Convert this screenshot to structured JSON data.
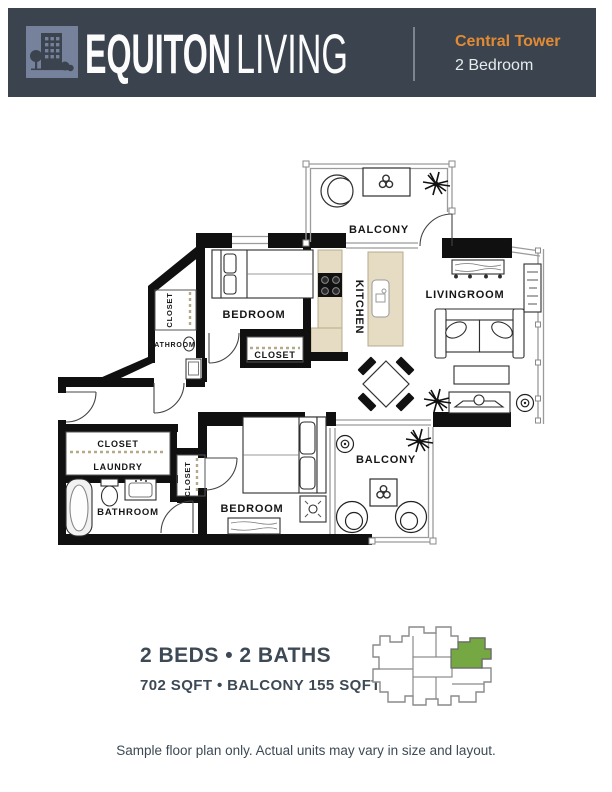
{
  "header": {
    "brand_bold": "EQUITON",
    "brand_light": "LIVING",
    "tower": "Central Tower",
    "unit_type": "2 Bedroom",
    "bg_color": "#3A434E",
    "accent_color": "#E28B33",
    "logo_color": "#76829B"
  },
  "floorplan": {
    "labels": {
      "balcony_top": "BALCONY",
      "kitchen": "KITCHEN",
      "livingroom": "LIVINGROOM",
      "bedroom_top": "BEDROOM",
      "closet_top_left": "CLOSET",
      "bathroom_top": "BATHROOM",
      "closet_mid": "CLOSET",
      "closet_lower_left": "CLOSET",
      "laundry": "LAUNDRY",
      "bathroom_lower": "BATHROOM",
      "closet_lower_mid": "CLOSET",
      "bedroom_lower": "BEDROOM",
      "balcony_lower": "BALCONY"
    },
    "counter_color": "#E5DCC3",
    "wall_color": "#101010"
  },
  "keyplan": {
    "highlight_color": "#75A843"
  },
  "summary": {
    "beds_baths": "2 BEDS • 2 BATHS",
    "sqft": "702 SQFT • BALCONY 155 SQFT",
    "disclaimer": "Sample floor plan only. Actual units may vary in size and layout."
  }
}
